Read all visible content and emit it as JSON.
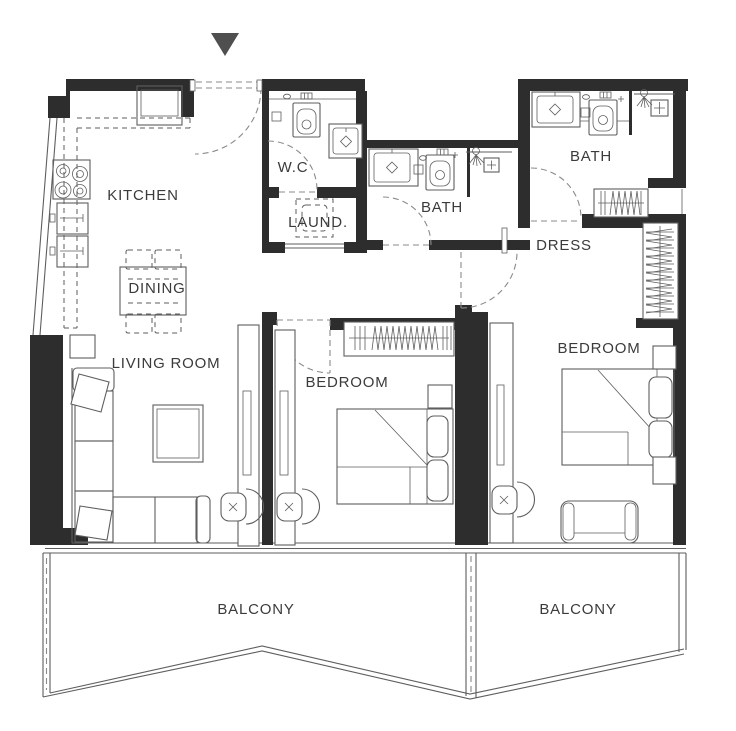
{
  "plan": {
    "background": "#ffffff",
    "wall_color": "#2d2d2d",
    "line_color": "#5e5e5e",
    "door_color": "#8a8a8a",
    "label_color": "#3b3b3b",
    "entrance_marker_color": "#4f4f4f",
    "rooms": [
      {
        "id": "kitchen",
        "label": "KITCHEN"
      },
      {
        "id": "wc",
        "label": "W.C"
      },
      {
        "id": "laundry",
        "label": "LAUND."
      },
      {
        "id": "bath-1",
        "label": "BATH"
      },
      {
        "id": "bath-2",
        "label": "BATH"
      },
      {
        "id": "dress",
        "label": "DRESS"
      },
      {
        "id": "dining",
        "label": "DINING"
      },
      {
        "id": "living-room",
        "label": "LIVING ROOM"
      },
      {
        "id": "bedroom-1",
        "label": "BEDROOM"
      },
      {
        "id": "bedroom-2",
        "label": "BEDROOM"
      },
      {
        "id": "balcony-1",
        "label": "BALCONY"
      },
      {
        "id": "balcony-2",
        "label": "BALCONY"
      }
    ]
  }
}
